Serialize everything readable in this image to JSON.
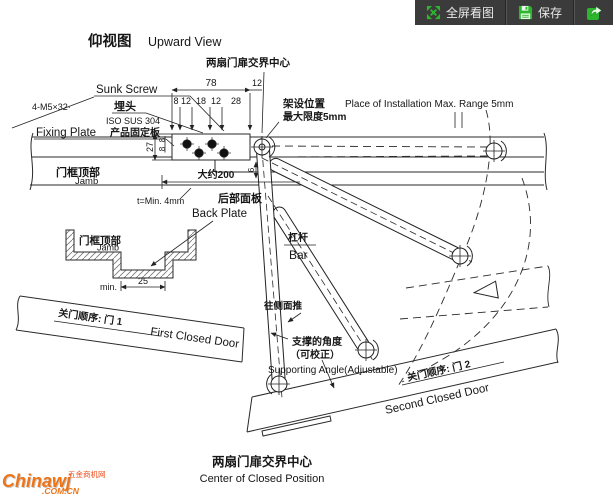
{
  "toolbar": {
    "fullscreen_label": "全屏看图",
    "save_label": "保存",
    "fullscreen_icon": "fullscreen-expand-icon",
    "save_icon": "save-floppy-icon",
    "share_icon": "share-arrow-icon",
    "bg_color": "#3b3b3b",
    "icon_color": "#2db52d",
    "text_color": "#eaeaea"
  },
  "title": {
    "cn": "仰视图",
    "en": "Upward View"
  },
  "top_center_label": "两扇门扉交界中心",
  "dimensions": {
    "total_width": "78",
    "offset_right": "12",
    "sub": [
      "8",
      "12",
      "18",
      "12",
      "28"
    ],
    "plate_height": "27",
    "row_offset_a": "8",
    "row_offset_b": "8",
    "gap": "6",
    "approx_length": "大约200",
    "recess_min": "min.",
    "recess_width": "25",
    "plate_thickness": "t=Min. 4mm"
  },
  "callouts": {
    "sunk_screw_en": "Sunk Screw",
    "sunk_screw_cn": "埋头",
    "screw_spec": "4-M5×32·",
    "material": "ISO SUS 304",
    "fixing_plate_en": "Fixing Plate",
    "fixing_plate_cn": "产品固定板",
    "install_cn": "架设位置",
    "install_en": "Place of Installation Max. Range 5mm",
    "max_range_cn": "最大限度5mm",
    "jamb_cn": "门框顶部",
    "jamb_en": "Jamb",
    "back_plate_cn": "后部面板",
    "back_plate_en": "Back Plate",
    "bar_cn": "杠杆",
    "bar_en": "Bar",
    "push_side_cn": "往侧面推",
    "support_angle_cn": "支撑的角度",
    "support_angle_cn_note": "（可校正）",
    "support_angle_en": "Supporting Angle(Adjustable)",
    "door1_cn": "关门顺序: 门 1",
    "door1_en": "First Closed Door",
    "door2_cn": "关门顺序: 门 2",
    "door2_en": "Second Closed Door"
  },
  "footer": {
    "cn": "两扇门扉交界中心",
    "en": "Center of Closed Position"
  },
  "watermark": {
    "brand": "Chinawj",
    "site_cn": "五金商机网",
    "domain": ".COM.CN",
    "brand_color": "#ee7418",
    "accent_color": "#ee4a18"
  }
}
